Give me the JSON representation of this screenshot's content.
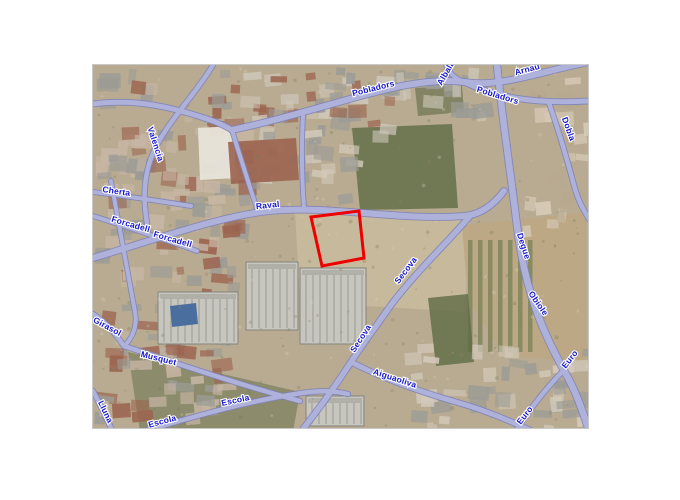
{
  "page": {
    "background": "#ffffff"
  },
  "map": {
    "frame": {
      "x": 93,
      "y": 65,
      "width": 495,
      "height": 363
    },
    "border_color": "#c9c9c9",
    "palette": {
      "ground": "#b9ab91",
      "field": "#c9ba9c",
      "green": "#7a8257",
      "green_dark": "#5f6b45",
      "roof_red": "#9c6450",
      "roof_gray": "#9b9b96",
      "road_casing": "#7e83b8",
      "road_fill": "#aeb2da",
      "label_color": "#1515cd",
      "label_halo": "#ffffff",
      "parcel_red": "#ee0000"
    },
    "parcel": {
      "points": "311,217 359,211 364,258 322,266",
      "stroke_width": 3
    },
    "roads": [
      {
        "d": "M 93 258 C 160 238 225 215 270 211 C 330 205 400 221 465 216 C 483 214 495 203 504 191",
        "w": 6
      },
      {
        "d": "M 497 65 C 503 125 509 160 517 226 C 525 292 543 333 567 376 C 577 394 584 415 590 434",
        "w": 6.5
      },
      {
        "d": "M 232 130 C 292 117 332 103 376 92 C 409 83 441 79 464 82 C 500 88 542 71 589 62",
        "w": 6
      },
      {
        "d": "M 464 82 C 498 98 534 104 589 101",
        "w": 5
      },
      {
        "d": "M 549 103 C 559 131 567 159 575 189 C 579 203 585 212 589 219",
        "w": 4.5
      },
      {
        "d": "M 446 65 C 450 75 457 79 464 82",
        "w": 4
      },
      {
        "d": "M 93 104 C 136 98 176 108 213 121 C 221 124 227 127 232 130",
        "w": 5
      },
      {
        "d": "M 213 65 C 192 100 162 126 150 161 C 144 179 143 200 147 223",
        "w": 4.5
      },
      {
        "d": "M 93 192 C 126 196 159 201 191 206",
        "w": 4
      },
      {
        "d": "M 93 216 C 128 227 163 239 197 251",
        "w": 4
      },
      {
        "d": "M 111 181 C 119 226 127 270 135 312 C 138 327 131 340 124 346",
        "w": 4
      },
      {
        "d": "M 93 314 C 104 321 115 333 124 346",
        "w": 4.5
      },
      {
        "d": "M 124 346 C 170 361 230 382 300 401",
        "w": 4.5
      },
      {
        "d": "M 138 433 C 192 417 247 401 302 393 C 322 390 336 391 348 394",
        "w": 4.5
      },
      {
        "d": "M 470 216 C 446 244 416 272 391 305 C 379 322 363 344 351 362 C 331 393 313 416 297 437",
        "w": 5.5
      },
      {
        "d": "M 351 362 C 386 380 421 392 456 402 C 481 409 511 421 536 433",
        "w": 5
      },
      {
        "d": "M 512 437 C 526 414 543 392 561 373",
        "w": 4.5
      },
      {
        "d": "M 303 116 C 301 148 302 180 304 208",
        "w": 4
      },
      {
        "d": "M 232 130 C 241 160 250 187 258 212",
        "w": 4
      },
      {
        "d": "M 93 391 C 101 406 108 421 115 437",
        "w": 4.5
      }
    ],
    "street_labels": [
      {
        "text": "Pobladors",
        "x": 374,
        "y": 91,
        "rot": -14
      },
      {
        "text": "Pobladors",
        "x": 497,
        "y": 98,
        "rot": 17
      },
      {
        "text": "Albalat",
        "x": 449,
        "y": 73,
        "rot": -60
      },
      {
        "text": "Arnau",
        "x": 528,
        "y": 72,
        "rot": -15
      },
      {
        "text": "Dobla",
        "x": 566,
        "y": 130,
        "rot": 70
      },
      {
        "text": "Degue",
        "x": 521,
        "y": 247,
        "rot": 72
      },
      {
        "text": "Obiole",
        "x": 536,
        "y": 305,
        "rot": 55
      },
      {
        "text": "Euro",
        "x": 572,
        "y": 361,
        "rot": -52
      },
      {
        "text": "Euro",
        "x": 527,
        "y": 417,
        "rot": -52
      },
      {
        "text": "Raval",
        "x": 268,
        "y": 208,
        "rot": -6
      },
      {
        "text": "Secova",
        "x": 408,
        "y": 272,
        "rot": -53
      },
      {
        "text": "Secova",
        "x": 363,
        "y": 340,
        "rot": -57
      },
      {
        "text": "Aiguaoliva",
        "x": 394,
        "y": 381,
        "rot": 18
      },
      {
        "text": "Escola",
        "x": 236,
        "y": 403,
        "rot": -12
      },
      {
        "text": "Escola",
        "x": 163,
        "y": 424,
        "rot": -15
      },
      {
        "text": "Musquet",
        "x": 158,
        "y": 361,
        "rot": 14
      },
      {
        "text": "Girasol",
        "x": 106,
        "y": 329,
        "rot": 28
      },
      {
        "text": "Cherta",
        "x": 116,
        "y": 194,
        "rot": 8
      },
      {
        "text": "Forcadell",
        "x": 130,
        "y": 227,
        "rot": 16
      },
      {
        "text": "Forcadell",
        "x": 172,
        "y": 242,
        "rot": 16
      },
      {
        "text": "Valencia",
        "x": 153,
        "y": 145,
        "rot": 72
      },
      {
        "text": "Lluna",
        "x": 103,
        "y": 413,
        "rot": 64
      }
    ],
    "terrain": [
      {
        "kind": "patch",
        "points": "295,212 470,216 465,312 300,302",
        "color": "field",
        "alpha": 0.9
      },
      {
        "kind": "patch",
        "points": "352,128 452,124 458,208 360,210",
        "color": "green_dark",
        "alpha": 0.8
      },
      {
        "kind": "patch",
        "points": "415,88 462,85 464,112 418,116",
        "color": "green_dark",
        "alpha": 0.6
      },
      {
        "kind": "patch",
        "points": "462,225 586,213 586,362 505,356 468,300",
        "color": "#bda784",
        "alpha": 0.9
      },
      {
        "kind": "rows",
        "x": 468,
        "y": 240,
        "w": 64,
        "h": 112,
        "gap": 10,
        "color": "green"
      },
      {
        "kind": "patch",
        "points": "428,298 468,294 474,362 436,366",
        "color": "green_dark",
        "alpha": 0.8
      },
      {
        "kind": "patch",
        "points": "128,352 300,392 293,432 140,432",
        "color": "green_dark",
        "alpha": 0.5
      },
      {
        "kind": "blocks",
        "x": 95,
        "y": 67,
        "w": 145,
        "h": 185,
        "count": 95,
        "colors": [
          "roof_red",
          "roof_gray",
          "#c7b6a4"
        ],
        "seed": 7
      },
      {
        "kind": "blocks",
        "x": 240,
        "y": 67,
        "w": 150,
        "h": 66,
        "count": 42,
        "colors": [
          "roof_gray",
          "#cfc8ba",
          "roof_red"
        ],
        "seed": 11
      },
      {
        "kind": "blocks",
        "x": 390,
        "y": 67,
        "w": 95,
        "h": 50,
        "count": 20,
        "colors": [
          "#cfc8ba",
          "roof_gray"
        ],
        "seed": 13
      },
      {
        "kind": "blocks",
        "x": 520,
        "y": 70,
        "w": 66,
        "h": 165,
        "count": 26,
        "colors": [
          "#d9cdb9",
          "#b7a88f"
        ],
        "seed": 17
      },
      {
        "kind": "blocks",
        "x": 95,
        "y": 258,
        "w": 135,
        "h": 160,
        "count": 70,
        "colors": [
          "roof_red",
          "roof_gray",
          "#c7b6a4"
        ],
        "seed": 19
      },
      {
        "kind": "blocks",
        "x": 400,
        "y": 338,
        "w": 185,
        "h": 92,
        "count": 38,
        "colors": [
          "#d3cabb",
          "roof_gray"
        ],
        "seed": 23
      },
      {
        "kind": "blocks",
        "x": 240,
        "y": 120,
        "w": 110,
        "h": 80,
        "count": 22,
        "colors": [
          "roof_gray",
          "#d3cabb"
        ],
        "seed": 29
      },
      {
        "kind": "patch",
        "points": "198,128 234,126 236,178 200,180",
        "color": "#e8e4da",
        "alpha": 0.95
      },
      {
        "kind": "patch",
        "points": "228,142 296,138 299,180 231,184",
        "color": "roof_red",
        "alpha": 0.9
      },
      {
        "kind": "warehouse",
        "x": 300,
        "y": 268,
        "w": 66,
        "h": 76
      },
      {
        "kind": "warehouse",
        "x": 246,
        "y": 262,
        "w": 52,
        "h": 68
      },
      {
        "kind": "warehouse",
        "x": 158,
        "y": 292,
        "w": 80,
        "h": 52
      },
      {
        "kind": "warehouse",
        "x": 306,
        "y": 396,
        "w": 58,
        "h": 30
      },
      {
        "kind": "patch",
        "points": "170,306 196,303 198,324 172,327",
        "color": "#4a6f9e",
        "alpha": 1
      }
    ]
  }
}
